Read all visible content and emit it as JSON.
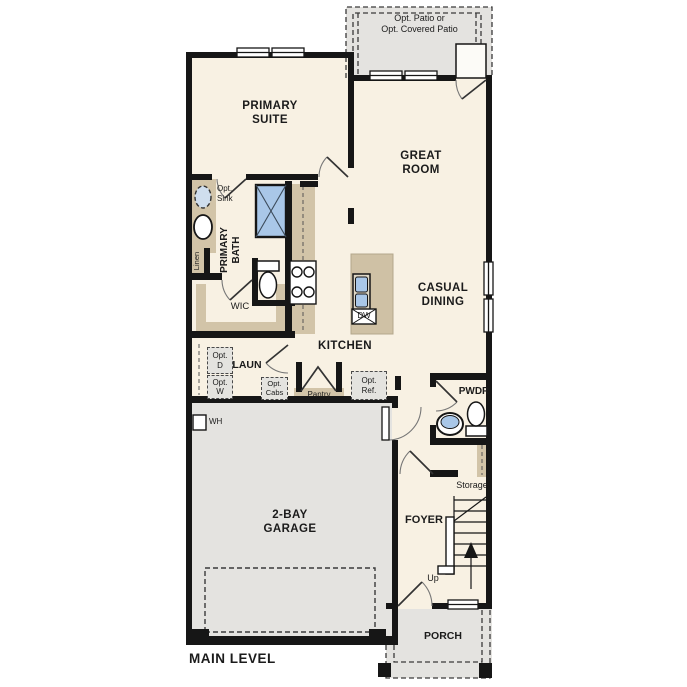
{
  "plan_title": "MAIN LEVEL",
  "colors": {
    "wall": "#161616",
    "floor": "#f8f1e3",
    "garage_patio_porch": "#e4e3e0",
    "cabinet_counter": "#d2c4a8",
    "water_fixture_blue": "#a9c7e8",
    "optional_item_fill": "#e4e3df"
  },
  "labels": {
    "patio": [
      "Opt. Patio or",
      "Opt. Covered Patio"
    ],
    "primary_suite": [
      "PRIMARY",
      "SUITE"
    ],
    "great_room": [
      "GREAT",
      "ROOM"
    ],
    "casual_dining": [
      "CASUAL",
      "DINING"
    ],
    "kitchen": "KITCHEN",
    "opt_sink": [
      "Opt.",
      "Sink"
    ],
    "primary_bath": [
      "PRIMARY",
      "BATH"
    ],
    "linen": "Linen",
    "wic": "WIC",
    "laun": "LAUN",
    "opt_d": [
      "Opt.",
      "D"
    ],
    "opt_w": [
      "Opt.",
      "W"
    ],
    "opt_cabs": [
      "Opt.",
      "Cabs"
    ],
    "pantry": "Pantry",
    "opt_ref": [
      "Opt.",
      "Ref."
    ],
    "dw": "DW",
    "pwdr": "PWDR",
    "wh": "WH",
    "storage": "Storage",
    "garage": [
      "2-BAY",
      "GARAGE"
    ],
    "foyer": "FOYER",
    "up": "Up",
    "porch": "PORCH",
    "main_level": "MAIN LEVEL"
  }
}
